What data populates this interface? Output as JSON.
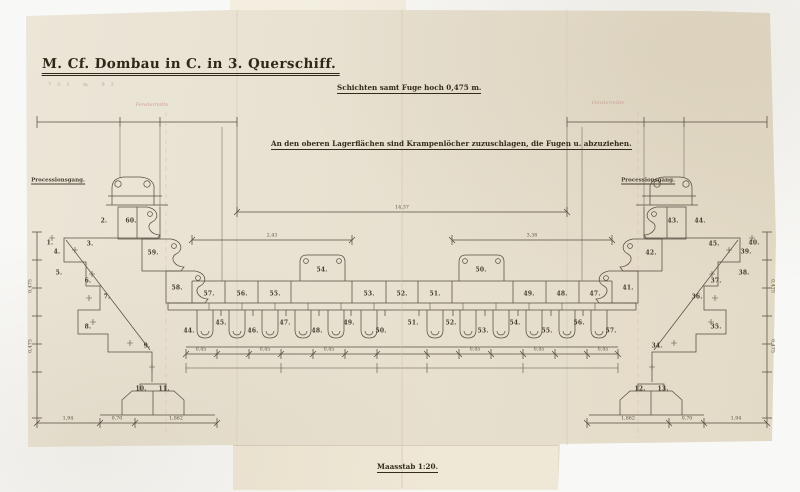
{
  "texts": {
    "title": "M. Cf. Dombau in C. in 3. Querschiff.",
    "title_pencil_note": "731  m  92",
    "annotation_top": "Schichten samt Fuge hoch 0,475 m.",
    "annotation_mid": "An den oberen Lagerflächen sind Krampenlöcher zuzuschlagen, die Fugen u. abzuziehen.",
    "scale_note": "Maasstab 1:20.",
    "gallery_label_left": "Processionsgang.",
    "gallery_label_right": "Processionsgang."
  },
  "colors": {
    "paper": "#e9e2d2",
    "paper_lower_strip": "#efe8d6",
    "ink": "#4a4236",
    "title_ink": "#2e2818",
    "axis_pink": "#c9a193",
    "crease": "#d8d0bf",
    "background": "#f8f8f6"
  },
  "drawing": {
    "axis_labels": [
      {
        "t": "Fenstermitte",
        "x": 152,
        "y": 105
      },
      {
        "t": "Fenstermitte",
        "x": 608,
        "y": 103
      }
    ],
    "stone_numbers": [
      {
        "t": "1.",
        "x": 50,
        "y": 243
      },
      {
        "t": "2.",
        "x": 104,
        "y": 221
      },
      {
        "t": "3.",
        "x": 90,
        "y": 244
      },
      {
        "t": "4.",
        "x": 57,
        "y": 252
      },
      {
        "t": "5.",
        "x": 59,
        "y": 273
      },
      {
        "t": "6.",
        "x": 88,
        "y": 281
      },
      {
        "t": "7.",
        "x": 107,
        "y": 297
      },
      {
        "t": "8.",
        "x": 88,
        "y": 327
      },
      {
        "t": "9.",
        "x": 147,
        "y": 346
      },
      {
        "t": "10.",
        "x": 141,
        "y": 389
      },
      {
        "t": "11.",
        "x": 164,
        "y": 389
      },
      {
        "t": "60.",
        "x": 131,
        "y": 221
      },
      {
        "t": "59.",
        "x": 153,
        "y": 253
      },
      {
        "t": "58.",
        "x": 177,
        "y": 288
      },
      {
        "t": "57.",
        "x": 209,
        "y": 294
      },
      {
        "t": "56.",
        "x": 242,
        "y": 294
      },
      {
        "t": "55.",
        "x": 275,
        "y": 294
      },
      {
        "t": "54.",
        "x": 322,
        "y": 270
      },
      {
        "t": "53.",
        "x": 369,
        "y": 294
      },
      {
        "t": "52.",
        "x": 402,
        "y": 294
      },
      {
        "t": "51.",
        "x": 435,
        "y": 294
      },
      {
        "t": "50.",
        "x": 481,
        "y": 270
      },
      {
        "t": "49.",
        "x": 529,
        "y": 294
      },
      {
        "t": "48.",
        "x": 562,
        "y": 294
      },
      {
        "t": "47.",
        "x": 595,
        "y": 294
      },
      {
        "t": "41.",
        "x": 628,
        "y": 288
      },
      {
        "t": "42.",
        "x": 651,
        "y": 253
      },
      {
        "t": "43.",
        "x": 673,
        "y": 221
      },
      {
        "t": "44.",
        "x": 700,
        "y": 221
      },
      {
        "t": "45.",
        "x": 714,
        "y": 244
      },
      {
        "t": "40.",
        "x": 754,
        "y": 243
      },
      {
        "t": "39.",
        "x": 746,
        "y": 252
      },
      {
        "t": "38.",
        "x": 744,
        "y": 273
      },
      {
        "t": "37.",
        "x": 716,
        "y": 281
      },
      {
        "t": "36.",
        "x": 697,
        "y": 297
      },
      {
        "t": "35.",
        "x": 716,
        "y": 327
      },
      {
        "t": "34.",
        "x": 657,
        "y": 346
      },
      {
        "t": "12.",
        "x": 640,
        "y": 389
      },
      {
        "t": "13.",
        "x": 663,
        "y": 389
      },
      {
        "t": "44.",
        "x": 189,
        "y": 331
      },
      {
        "t": "45.",
        "x": 221,
        "y": 323
      },
      {
        "t": "46.",
        "x": 253,
        "y": 331
      },
      {
        "t": "47.",
        "x": 285,
        "y": 323
      },
      {
        "t": "48.",
        "x": 317,
        "y": 331
      },
      {
        "t": "49.",
        "x": 349,
        "y": 323
      },
      {
        "t": "50.",
        "x": 381,
        "y": 331
      },
      {
        "t": "51.",
        "x": 413,
        "y": 323
      },
      {
        "t": "52.",
        "x": 451,
        "y": 323
      },
      {
        "t": "53.",
        "x": 483,
        "y": 331
      },
      {
        "t": "54.",
        "x": 515,
        "y": 323
      },
      {
        "t": "55.",
        "x": 547,
        "y": 331
      },
      {
        "t": "56.",
        "x": 579,
        "y": 323
      },
      {
        "t": "57.",
        "x": 611,
        "y": 331
      }
    ],
    "dimensions": [
      {
        "t": "14,37",
        "x": 402,
        "y": 208
      },
      {
        "t": "2,43",
        "x": 272,
        "y": 236
      },
      {
        "t": "3,38",
        "x": 532,
        "y": 236
      },
      {
        "t": "1,94",
        "x": 68,
        "y": 419
      },
      {
        "t": "0,70",
        "x": 117,
        "y": 419
      },
      {
        "t": "1,862",
        "x": 176,
        "y": 419
      },
      {
        "t": "1,862",
        "x": 628,
        "y": 419
      },
      {
        "t": "0,70",
        "x": 687,
        "y": 419
      },
      {
        "t": "1,94",
        "x": 736,
        "y": 419
      },
      {
        "t": "0,45",
        "x": 201,
        "y": 350
      },
      {
        "t": "0,45",
        "x": 265,
        "y": 350
      },
      {
        "t": "0,45",
        "x": 329,
        "y": 350
      },
      {
        "t": "0,45",
        "x": 475,
        "y": 350
      },
      {
        "t": "0,45",
        "x": 539,
        "y": 350
      },
      {
        "t": "0,45",
        "x": 603,
        "y": 350
      },
      {
        "t": "0,475",
        "x": 31,
        "y": 286,
        "rot": -90
      },
      {
        "t": "0,475",
        "x": 31,
        "y": 346,
        "rot": -90
      },
      {
        "t": "0,475",
        "x": 772,
        "y": 286,
        "rot": 90
      },
      {
        "t": "0,475",
        "x": 772,
        "y": 346,
        "rot": 90
      }
    ]
  }
}
